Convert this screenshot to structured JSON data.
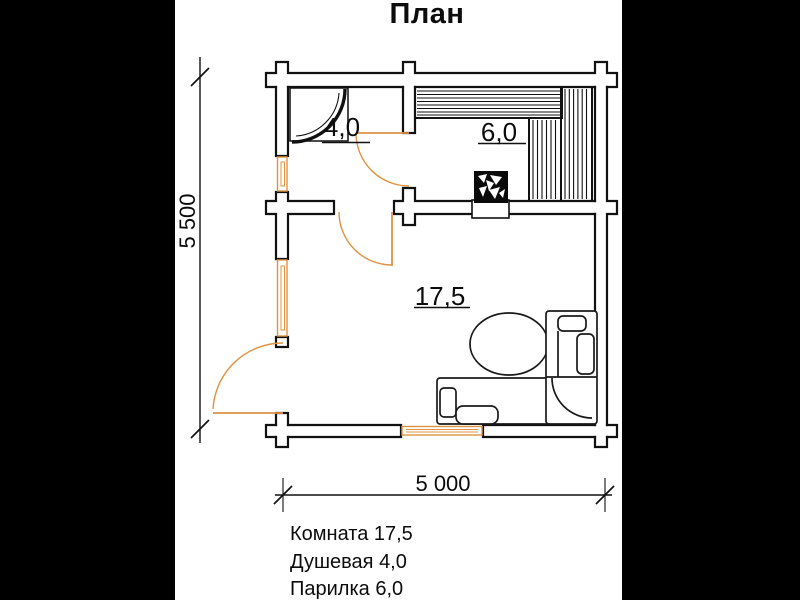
{
  "title": "План",
  "plan_labels": {
    "room_main": "17,5",
    "room_shower": "4,0",
    "room_steam": "6,0"
  },
  "dimensions": {
    "width": "5 000",
    "height": "5 500"
  },
  "legend": {
    "items": [
      "Комната 17,5",
      "Душевая 4,0",
      "Парилка 6,0"
    ]
  },
  "rooms": [
    {
      "name": "Комната",
      "area": "17,5"
    },
    {
      "name": "Душевая",
      "area": "4,0"
    },
    {
      "name": "Парилка",
      "area": "6,0"
    }
  ],
  "colors": {
    "line": "#111111",
    "accent_orange": "#df9342",
    "paper": "#ffffff",
    "matte": "#000000"
  }
}
